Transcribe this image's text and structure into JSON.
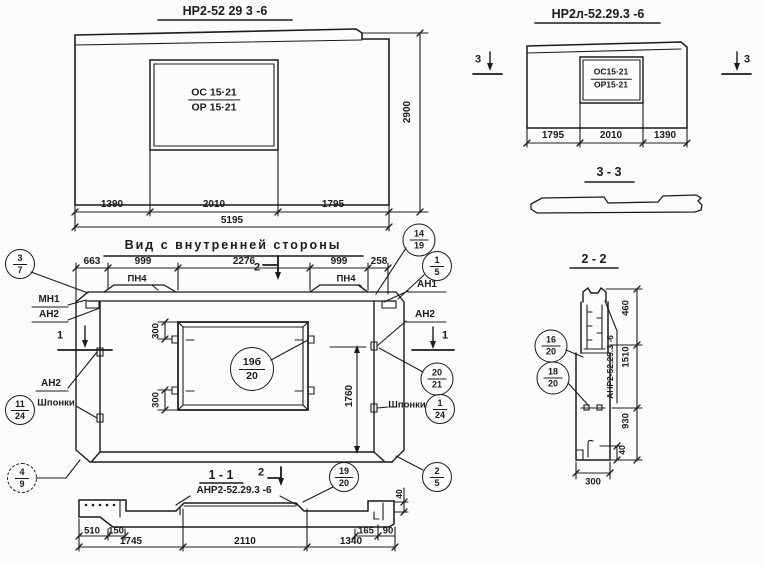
{
  "colors": {
    "ink": "#1b1b1b",
    "paper": "#fcfcfa"
  },
  "drawing": {
    "front_view": {
      "title": "НР2-52 29 3 -6",
      "opening_mark": {
        "top": "ОС 15·21",
        "bottom": "ОР 15·21"
      },
      "dim_left": "1390",
      "dim_mid": "2010",
      "dim_right": "1795",
      "dim_total": "5195",
      "dim_height": "2900"
    },
    "left_view": {
      "title": "НР2л-52.29.3 -6",
      "opening_mark": {
        "top": "ОС15·21",
        "bottom": "ОР15·21"
      },
      "dim_left": "1795",
      "dim_mid": "2010",
      "dim_right": "1390",
      "section_mark": "3"
    },
    "section_3_3": {
      "title": "3 - 3"
    },
    "inner_view": {
      "title": "Вид с внутренней стороны",
      "dims_top": [
        "663",
        "999",
        "2276",
        "999",
        "258"
      ],
      "section_mark_1": "1",
      "section_mark_2": "2",
      "embed_pn4": "ПН4",
      "embed_mn1": "МН1",
      "embed_an2": "АН2",
      "embed_an1": "АН1",
      "keys_label": "Шпонки",
      "dim_300": "300",
      "dim_1760": "1760"
    },
    "section_1_1": {
      "title": "1 - 1",
      "label": "АНР2-52.29.3 -6",
      "dim_40": "40",
      "dims_left": [
        "510",
        "150"
      ],
      "dims_main": [
        "1745",
        "2110",
        "1340"
      ],
      "dims_right": [
        "165",
        "90"
      ]
    },
    "section_2_2": {
      "title": "2 - 2",
      "label_vertical": "АНР2-52.29.3 -6",
      "dim_460": "460",
      "dim_1510": "1510",
      "dim_930": "930",
      "dim_40": "40",
      "dim_300": "300"
    },
    "callouts": {
      "c3_7": {
        "top": "3",
        "bottom": "7"
      },
      "c14_19": {
        "top": "14",
        "bottom": "19"
      },
      "c1_5": {
        "top": "1",
        "bottom": "5"
      },
      "c11_24": {
        "top": "11",
        "bottom": "24"
      },
      "c19b_20": {
        "top": "19б",
        "bottom": "20"
      },
      "c20_21": {
        "top": "20",
        "bottom": "21"
      },
      "c1_24": {
        "top": "1",
        "bottom": "24"
      },
      "c4_9": {
        "top": "4",
        "bottom": "9"
      },
      "c2_5": {
        "top": "2",
        "bottom": "5"
      },
      "c19_20": {
        "top": "19",
        "bottom": "20"
      },
      "c16_20": {
        "top": "16",
        "bottom": "20"
      },
      "c18_20": {
        "top": "18",
        "bottom": "20"
      }
    }
  }
}
